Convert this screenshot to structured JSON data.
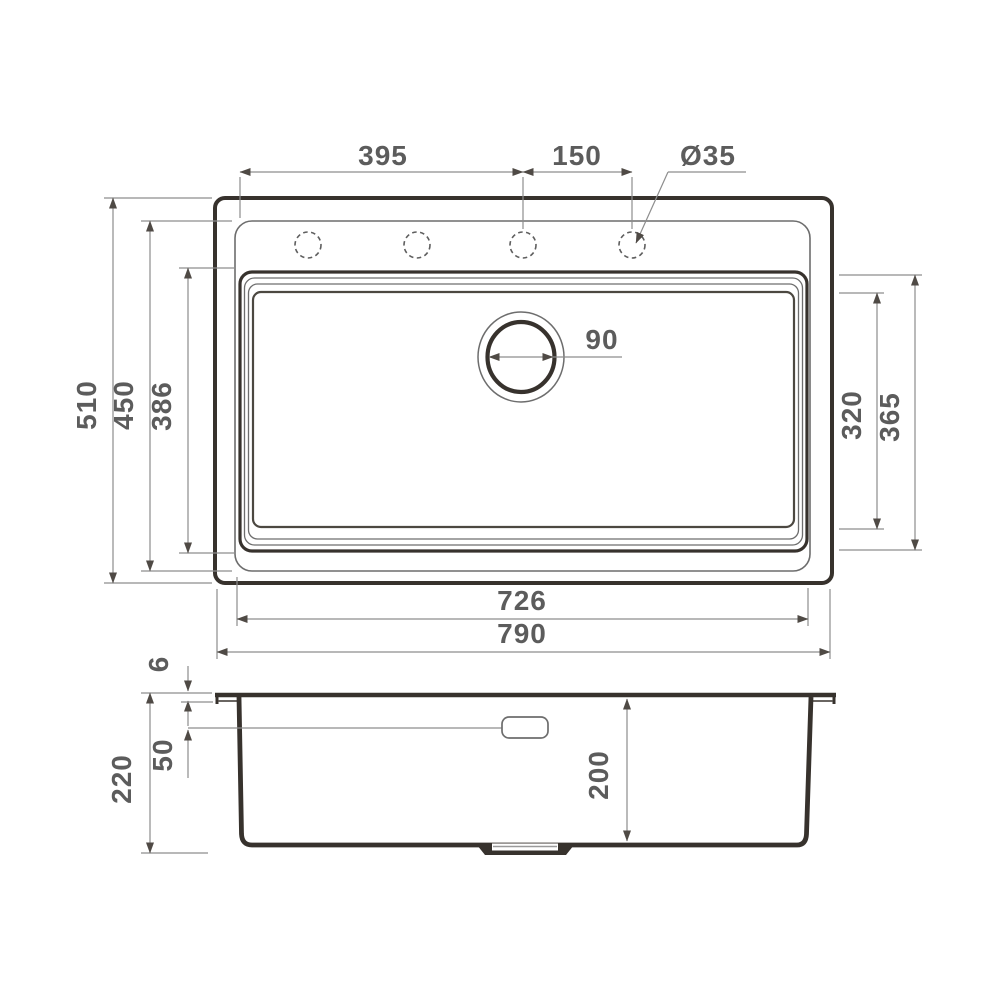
{
  "drawing": {
    "background": "#ffffff",
    "colors": {
      "heavy_line": "#37322d",
      "light_line": "#6d6d6d",
      "dimension_line": "#8d8d8d",
      "arrow": "#4f4a45",
      "label_text": "#5c5c5c"
    },
    "top_view": {
      "labels": {
        "hole_pitch_main": "395",
        "hole_pitch_end": "150",
        "faucet_hole_diameter": "Ø35",
        "drain_diameter": "90",
        "overall_depth": "510",
        "rim_inner_depth": "450",
        "bowl_outer_depth": "386",
        "bowl_inner_front_back": "320",
        "bowl_outer_front_back": "365",
        "bowl_length": "726",
        "overall_length": "790"
      },
      "faucet_hole_count": 4
    },
    "section_view": {
      "labels": {
        "rim_height": "6",
        "overflow_offset": "50",
        "overall_height": "220",
        "bowl_depth": "200"
      }
    }
  }
}
